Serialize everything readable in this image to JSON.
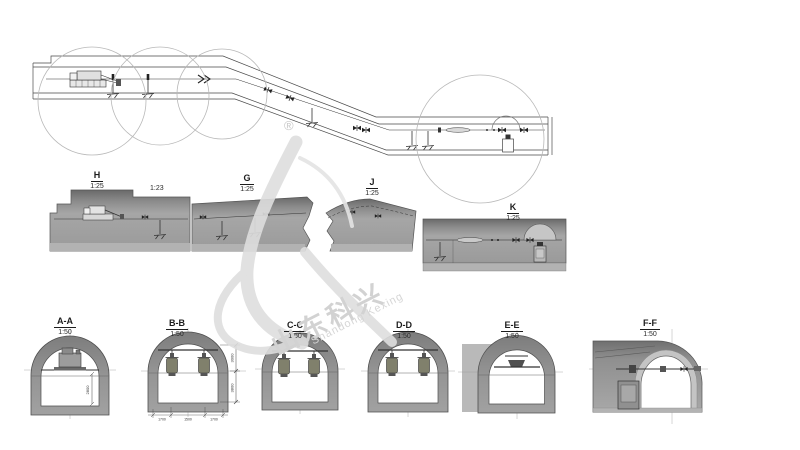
{
  "drawing": {
    "title": "tunnel equipment installation drawing",
    "background": "#ffffff",
    "line_color": "#4a4a4a",
    "profile_gray": "#9b9b9b",
    "wall_gray": "#8f8f8f",
    "watermark_gray": "#dedede"
  },
  "watermark": {
    "cn": "山东科兴",
    "en": "Shandong Kexing",
    "registered": "®"
  },
  "profiles": [
    {
      "label": "H",
      "scale": "1:25"
    },
    {
      "label": "G",
      "scale": "1:25"
    },
    {
      "label": "J",
      "scale": "1:25"
    },
    {
      "label": "K",
      "scale": "1:25"
    }
  ],
  "detail_scale_label": "1:23",
  "cross_sections": [
    {
      "label": "A-A",
      "scale": "1:50"
    },
    {
      "label": "B-B",
      "scale": "1:50"
    },
    {
      "label": "C-C",
      "scale": "1:50"
    },
    {
      "label": "D-D",
      "scale": "1:50"
    },
    {
      "label": "E-E",
      "scale": "1:50"
    },
    {
      "label": "F-F",
      "scale": "1:50"
    }
  ],
  "dimensions": {
    "aa_height": "2800",
    "bb_height_upper": "3000",
    "bb_height_lower": "3800",
    "bb_width_left": "1700",
    "bb_width_mid": "1500",
    "bb_width_right": "1700"
  }
}
